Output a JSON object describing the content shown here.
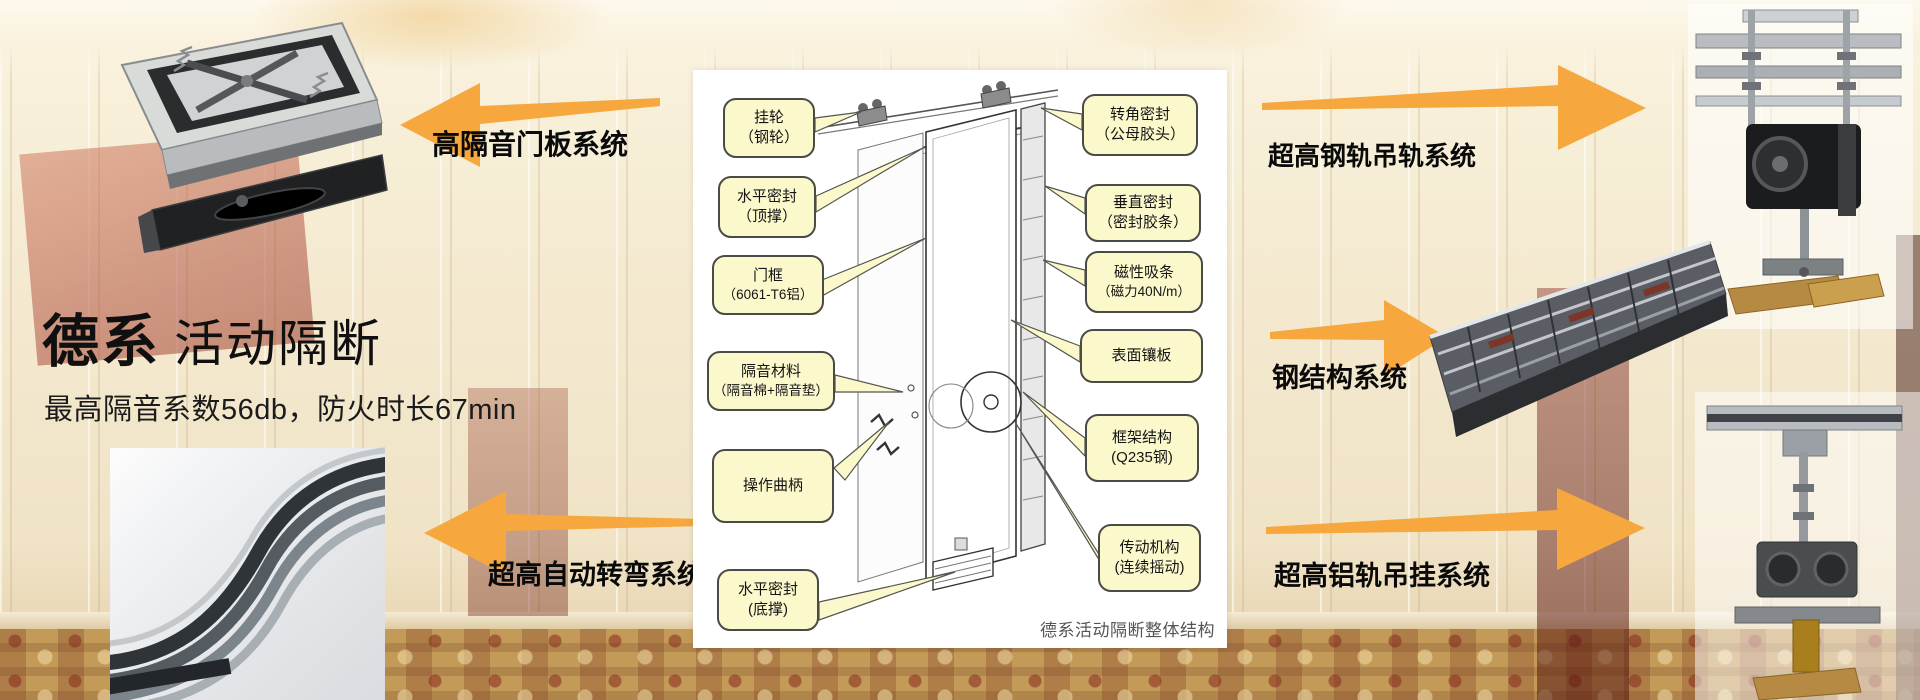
{
  "colors": {
    "arrow_orange": "#F6A73E",
    "callout_bg": "#FBF9CC",
    "callout_border": "#4B4B45",
    "headline_text": "#101010"
  },
  "headline": {
    "brand": "德系",
    "product": "活动隔断",
    "subtitle": "最高隔音系数56db，防火时长67min"
  },
  "feature_labels": {
    "top_left": "高隔音门板系统",
    "bottom_left": "超高自动转弯系统",
    "top_right": "超高钢轨吊轨系统",
    "middle_right": "钢结构系统",
    "bottom_right": "超高铝轨吊挂系统"
  },
  "diagram": {
    "caption": "德系活动隔断整体结构",
    "left_callouts": [
      {
        "line1": "挂轮",
        "line2": "（钢轮）"
      },
      {
        "line1": "水平密封",
        "line2": "（顶撑）"
      },
      {
        "line1": "门框",
        "line2": "（6061-T6铝）"
      },
      {
        "line1": "隔音材料",
        "line2": "（隔音棉+隔音垫）"
      },
      {
        "line1": "操作曲柄",
        "line2": ""
      },
      {
        "line1": "水平密封",
        "line2": "(底撑)"
      }
    ],
    "right_callouts": [
      {
        "line1": "转角密封",
        "line2": "（公母胶头）"
      },
      {
        "line1": "垂直密封",
        "line2": "（密封胶条）"
      },
      {
        "line1": "磁性吸条",
        "line2": "（磁力40N/m）"
      },
      {
        "line1": "表面镶板",
        "line2": ""
      },
      {
        "line1": "框架结构",
        "line2": "(Q235钢)"
      },
      {
        "line1": "传动机构",
        "line2": "(连续摇动)"
      }
    ]
  }
}
